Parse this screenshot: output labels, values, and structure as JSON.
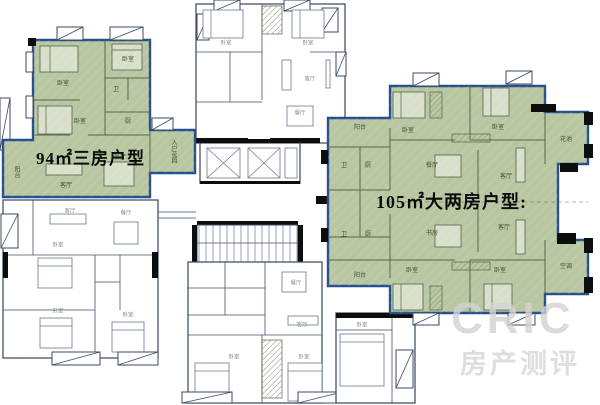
{
  "labels": {
    "unit_a_area": "94㎡三房户型",
    "unit_b_area": "105㎡大两房户型:"
  },
  "watermark": {
    "brand": "CRIC",
    "subtitle": "房产测评"
  },
  "colors": {
    "background": "#ffffff",
    "highlight_fill": "#b8c7a1",
    "highlight_border": "#27508e",
    "wall_line": "#44516b",
    "wall_black": "#0d0d0d",
    "inner_green_line": "#59684b",
    "room_label_green": "#3f4d33",
    "room_label_gray": "#8f8f8f",
    "watermark_color": "#d3d3d3"
  },
  "room_labels": [
    {
      "t": "卧室",
      "x": 63,
      "y": 84,
      "c": "g"
    },
    {
      "t": "卧室",
      "x": 128,
      "y": 60,
      "c": "g"
    },
    {
      "t": "卧室",
      "x": 80,
      "y": 122,
      "c": "g"
    },
    {
      "t": "卫",
      "x": 116,
      "y": 90,
      "c": "g"
    },
    {
      "t": "厨",
      "x": 128,
      "y": 122,
      "c": "g"
    },
    {
      "t": "客厅",
      "x": 66,
      "y": 186,
      "c": "g"
    },
    {
      "t": "餐厅",
      "x": 120,
      "y": 158,
      "c": "g"
    },
    {
      "t": "阳台",
      "x": 16,
      "y": 172,
      "c": "g",
      "v": 1
    },
    {
      "t": "入户花园",
      "x": 173,
      "y": 151,
      "c": "g",
      "v": 1
    },
    {
      "t": "阳台",
      "x": 360,
      "y": 128,
      "c": "g"
    },
    {
      "t": "卧室",
      "x": 408,
      "y": 131,
      "c": "g"
    },
    {
      "t": "卧室",
      "x": 498,
      "y": 128,
      "c": "g"
    },
    {
      "t": "卫",
      "x": 344,
      "y": 166,
      "c": "g"
    },
    {
      "t": "厨",
      "x": 368,
      "y": 166,
      "c": "g"
    },
    {
      "t": "餐厅",
      "x": 432,
      "y": 166,
      "c": "g"
    },
    {
      "t": "客厅",
      "x": 506,
      "y": 177,
      "c": "g"
    },
    {
      "t": "花池",
      "x": 566,
      "y": 140,
      "c": "g"
    },
    {
      "t": "书房",
      "x": 432,
      "y": 234,
      "c": "g"
    },
    {
      "t": "客厅",
      "x": 504,
      "y": 228,
      "c": "g"
    },
    {
      "t": "卫",
      "x": 344,
      "y": 235,
      "c": "g"
    },
    {
      "t": "厨",
      "x": 368,
      "y": 235,
      "c": "g"
    },
    {
      "t": "阳台",
      "x": 360,
      "y": 276,
      "c": "g"
    },
    {
      "t": "卧室",
      "x": 412,
      "y": 271,
      "c": "g"
    },
    {
      "t": "卧室",
      "x": 500,
      "y": 271,
      "c": "g"
    },
    {
      "t": "空调",
      "x": 566,
      "y": 267,
      "c": "g"
    },
    {
      "t": "卧室",
      "x": 226,
      "y": 44,
      "c": "w"
    },
    {
      "t": "卧室",
      "x": 308,
      "y": 44,
      "c": "w"
    },
    {
      "t": "客厅",
      "x": 310,
      "y": 80,
      "c": "w"
    },
    {
      "t": "餐厅",
      "x": 300,
      "y": 114,
      "c": "w"
    },
    {
      "t": "客厅",
      "x": 70,
      "y": 212,
      "c": "w"
    },
    {
      "t": "餐厅",
      "x": 126,
      "y": 214,
      "c": "w"
    },
    {
      "t": "卧室",
      "x": 58,
      "y": 246,
      "c": "w"
    },
    {
      "t": "卧室",
      "x": 58,
      "y": 312,
      "c": "w"
    },
    {
      "t": "卧室",
      "x": 128,
      "y": 316,
      "c": "w"
    },
    {
      "t": "餐厅",
      "x": 296,
      "y": 284,
      "c": "w"
    },
    {
      "t": "客厅",
      "x": 302,
      "y": 326,
      "c": "w"
    },
    {
      "t": "卧室",
      "x": 234,
      "y": 358,
      "c": "w"
    },
    {
      "t": "卧室",
      "x": 304,
      "y": 358,
      "c": "w"
    },
    {
      "t": "卧室",
      "x": 362,
      "y": 326,
      "c": "w"
    }
  ]
}
